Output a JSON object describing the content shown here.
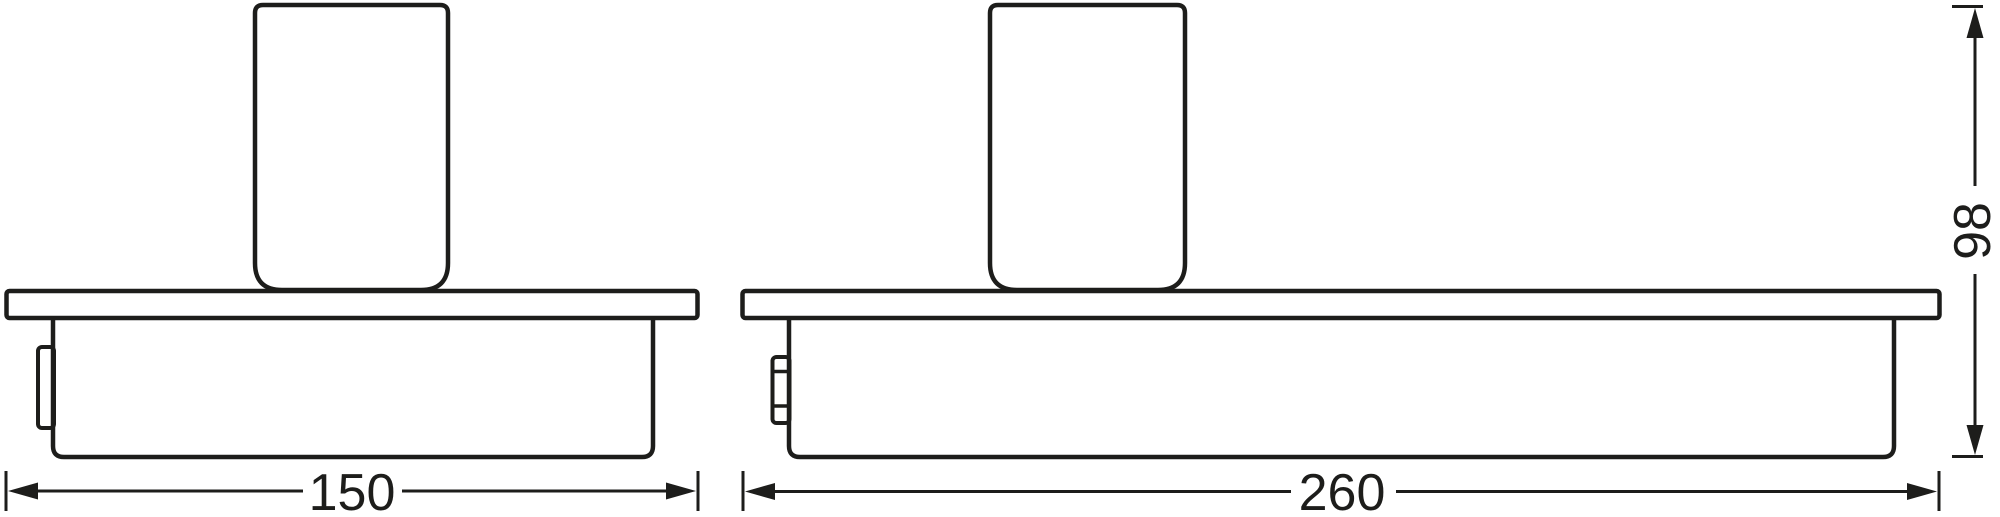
{
  "page": {
    "background": "#ffffff",
    "line_color": "#1d1d1b",
    "description": "Technical line drawing of two wall-mounted shelf fixtures with tumbler, with dimension lines"
  },
  "views": {
    "left": {
      "name": "front-view-small-model",
      "width_label": "150"
    },
    "right": {
      "name": "front-view-large-model",
      "width_label": "260"
    },
    "height_label": "98"
  }
}
